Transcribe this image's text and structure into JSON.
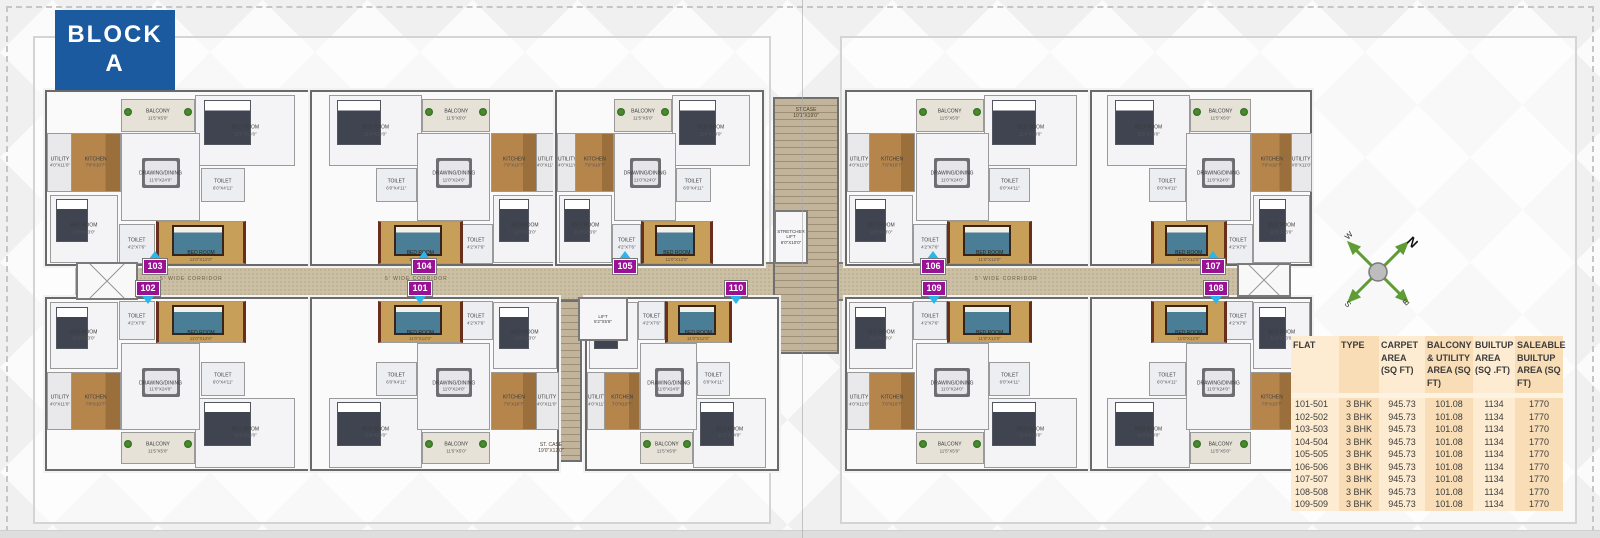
{
  "block": {
    "line1": "BLOCK",
    "line2": "A"
  },
  "compass": {
    "n": "N",
    "e": "E",
    "s": "S",
    "w": "W"
  },
  "colors": {
    "block_blue": "#1b5a9e",
    "badge_magenta": "#9b1196",
    "arrow_cyan": "#29b6e8",
    "corridor_tan": "#cbbfa4",
    "table_light": "#fdecd1",
    "table_dark": "#f8ddb6"
  },
  "plan": {
    "corridor_label": "5' WIDE CORRIDOR",
    "stair_top": {
      "label": "ST.CASE",
      "dims": "10'1\"X19'0\""
    },
    "stair_bottom": {
      "label": "ST. CASE",
      "dims": "19'0\"X12'0\""
    },
    "lift": {
      "label": "LIFT",
      "dims": "5'2\"X5'6\""
    },
    "stretcher_lift": {
      "label": "STRETCHER LIFT",
      "dims": "6'0\"X10'0\""
    },
    "units": [
      {
        "id": "103",
        "x": 45,
        "y": 90,
        "w": 265,
        "h": 172,
        "row": "top",
        "flip": false,
        "badge_x": 155
      },
      {
        "id": "104",
        "x": 310,
        "y": 90,
        "w": 245,
        "h": 172,
        "row": "top",
        "flip": true,
        "badge_x": 424
      },
      {
        "id": "105",
        "x": 555,
        "y": 90,
        "w": 205,
        "h": 172,
        "row": "top",
        "flip": false,
        "badge_x": 625
      },
      {
        "id": "106",
        "x": 845,
        "y": 90,
        "w": 245,
        "h": 172,
        "row": "top",
        "flip": false,
        "badge_x": 933
      },
      {
        "id": "107",
        "x": 1090,
        "y": 90,
        "w": 218,
        "h": 172,
        "row": "top",
        "flip": true,
        "badge_x": 1213
      },
      {
        "id": "102",
        "x": 45,
        "y": 297,
        "w": 265,
        "h": 170,
        "row": "bottom",
        "flip": false,
        "badge_x": 148
      },
      {
        "id": "101",
        "x": 310,
        "y": 297,
        "w": 245,
        "h": 170,
        "row": "bottom",
        "flip": true,
        "badge_x": 420
      },
      {
        "id": "110",
        "x": 585,
        "y": 297,
        "w": 190,
        "h": 170,
        "row": "bottom",
        "flip": false,
        "badge_x": 736
      },
      {
        "id": "109",
        "x": 845,
        "y": 297,
        "w": 245,
        "h": 170,
        "row": "bottom",
        "flip": false,
        "badge_x": 934
      },
      {
        "id": "108",
        "x": 1090,
        "y": 297,
        "w": 218,
        "h": 170,
        "row": "bottom",
        "flip": true,
        "badge_x": 1216
      }
    ],
    "room_template": [
      {
        "label": "UTILITY",
        "dims": "4'0\"X11'0\"",
        "type": "utility",
        "x": 0,
        "y": 24,
        "w": 9,
        "h": 33
      },
      {
        "label": "KITCHEN",
        "dims": "7'0\"X10'7\"",
        "type": "kitchen",
        "x": 9,
        "y": 24,
        "w": 18,
        "h": 33
      },
      {
        "label": "BALCONY",
        "dims": "11'5\"X5'0\"",
        "type": "balcony",
        "x": 28,
        "y": 4,
        "w": 27,
        "h": 18
      },
      {
        "label": "BED ROOM",
        "dims": "11'0\"X14'0\"",
        "type": "bedroom",
        "x": 56,
        "y": 2,
        "w": 37,
        "h": 40
      },
      {
        "label": "DRAWING/DINING",
        "dims": "11'0\"X24'0\"",
        "type": "drawing",
        "x": 28,
        "y": 24,
        "w": 29,
        "h": 50
      },
      {
        "label": "TOILET",
        "dims": "6'0\"X4'11\"",
        "type": "toilet",
        "x": 58,
        "y": 44,
        "w": 16,
        "h": 19
      },
      {
        "label": "BED ROOM",
        "dims": "11'0\"X13'0\"",
        "type": "bedroom",
        "x": 1,
        "y": 60,
        "w": 25,
        "h": 38
      },
      {
        "label": "TOILET",
        "dims": "4'2\"X7'6\"",
        "type": "toilet",
        "x": 27,
        "y": 77,
        "w": 13,
        "h": 22
      },
      {
        "label": "BED ROOM",
        "dims": "11'0\"X12'0\"",
        "type": "master",
        "x": 41,
        "y": 75,
        "w": 32,
        "h": 24
      }
    ]
  },
  "table": {
    "headers": [
      "FLAT",
      "TYPE",
      "CARPET AREA (SQ FT)",
      "BALCONY & UTILITY AREA (SQ FT)",
      "BUILTUP AREA (SQ .FT)",
      "SALEABLE BUILTUP AREA (SQ FT)"
    ],
    "rows": [
      [
        "101-501",
        "3 BHK",
        "945.73",
        "101.08",
        "1134",
        "1770"
      ],
      [
        "102-502",
        "3 BHK",
        "945.73",
        "101.08",
        "1134",
        "1770"
      ],
      [
        "103-503",
        "3 BHK",
        "945.73",
        "101.08",
        "1134",
        "1770"
      ],
      [
        "104-504",
        "3 BHK",
        "945.73",
        "101.08",
        "1134",
        "1770"
      ],
      [
        "105-505",
        "3 BHK",
        "945.73",
        "101.08",
        "1134",
        "1770"
      ],
      [
        "106-506",
        "3 BHK",
        "945.73",
        "101.08",
        "1134",
        "1770"
      ],
      [
        "107-507",
        "3 BHK",
        "945.73",
        "101.08",
        "1134",
        "1770"
      ],
      [
        "108-508",
        "3 BHK",
        "945.73",
        "101.08",
        "1134",
        "1770"
      ],
      [
        "109-509",
        "3 BHK",
        "945.73",
        "101.08",
        "1134",
        "1770"
      ]
    ]
  }
}
